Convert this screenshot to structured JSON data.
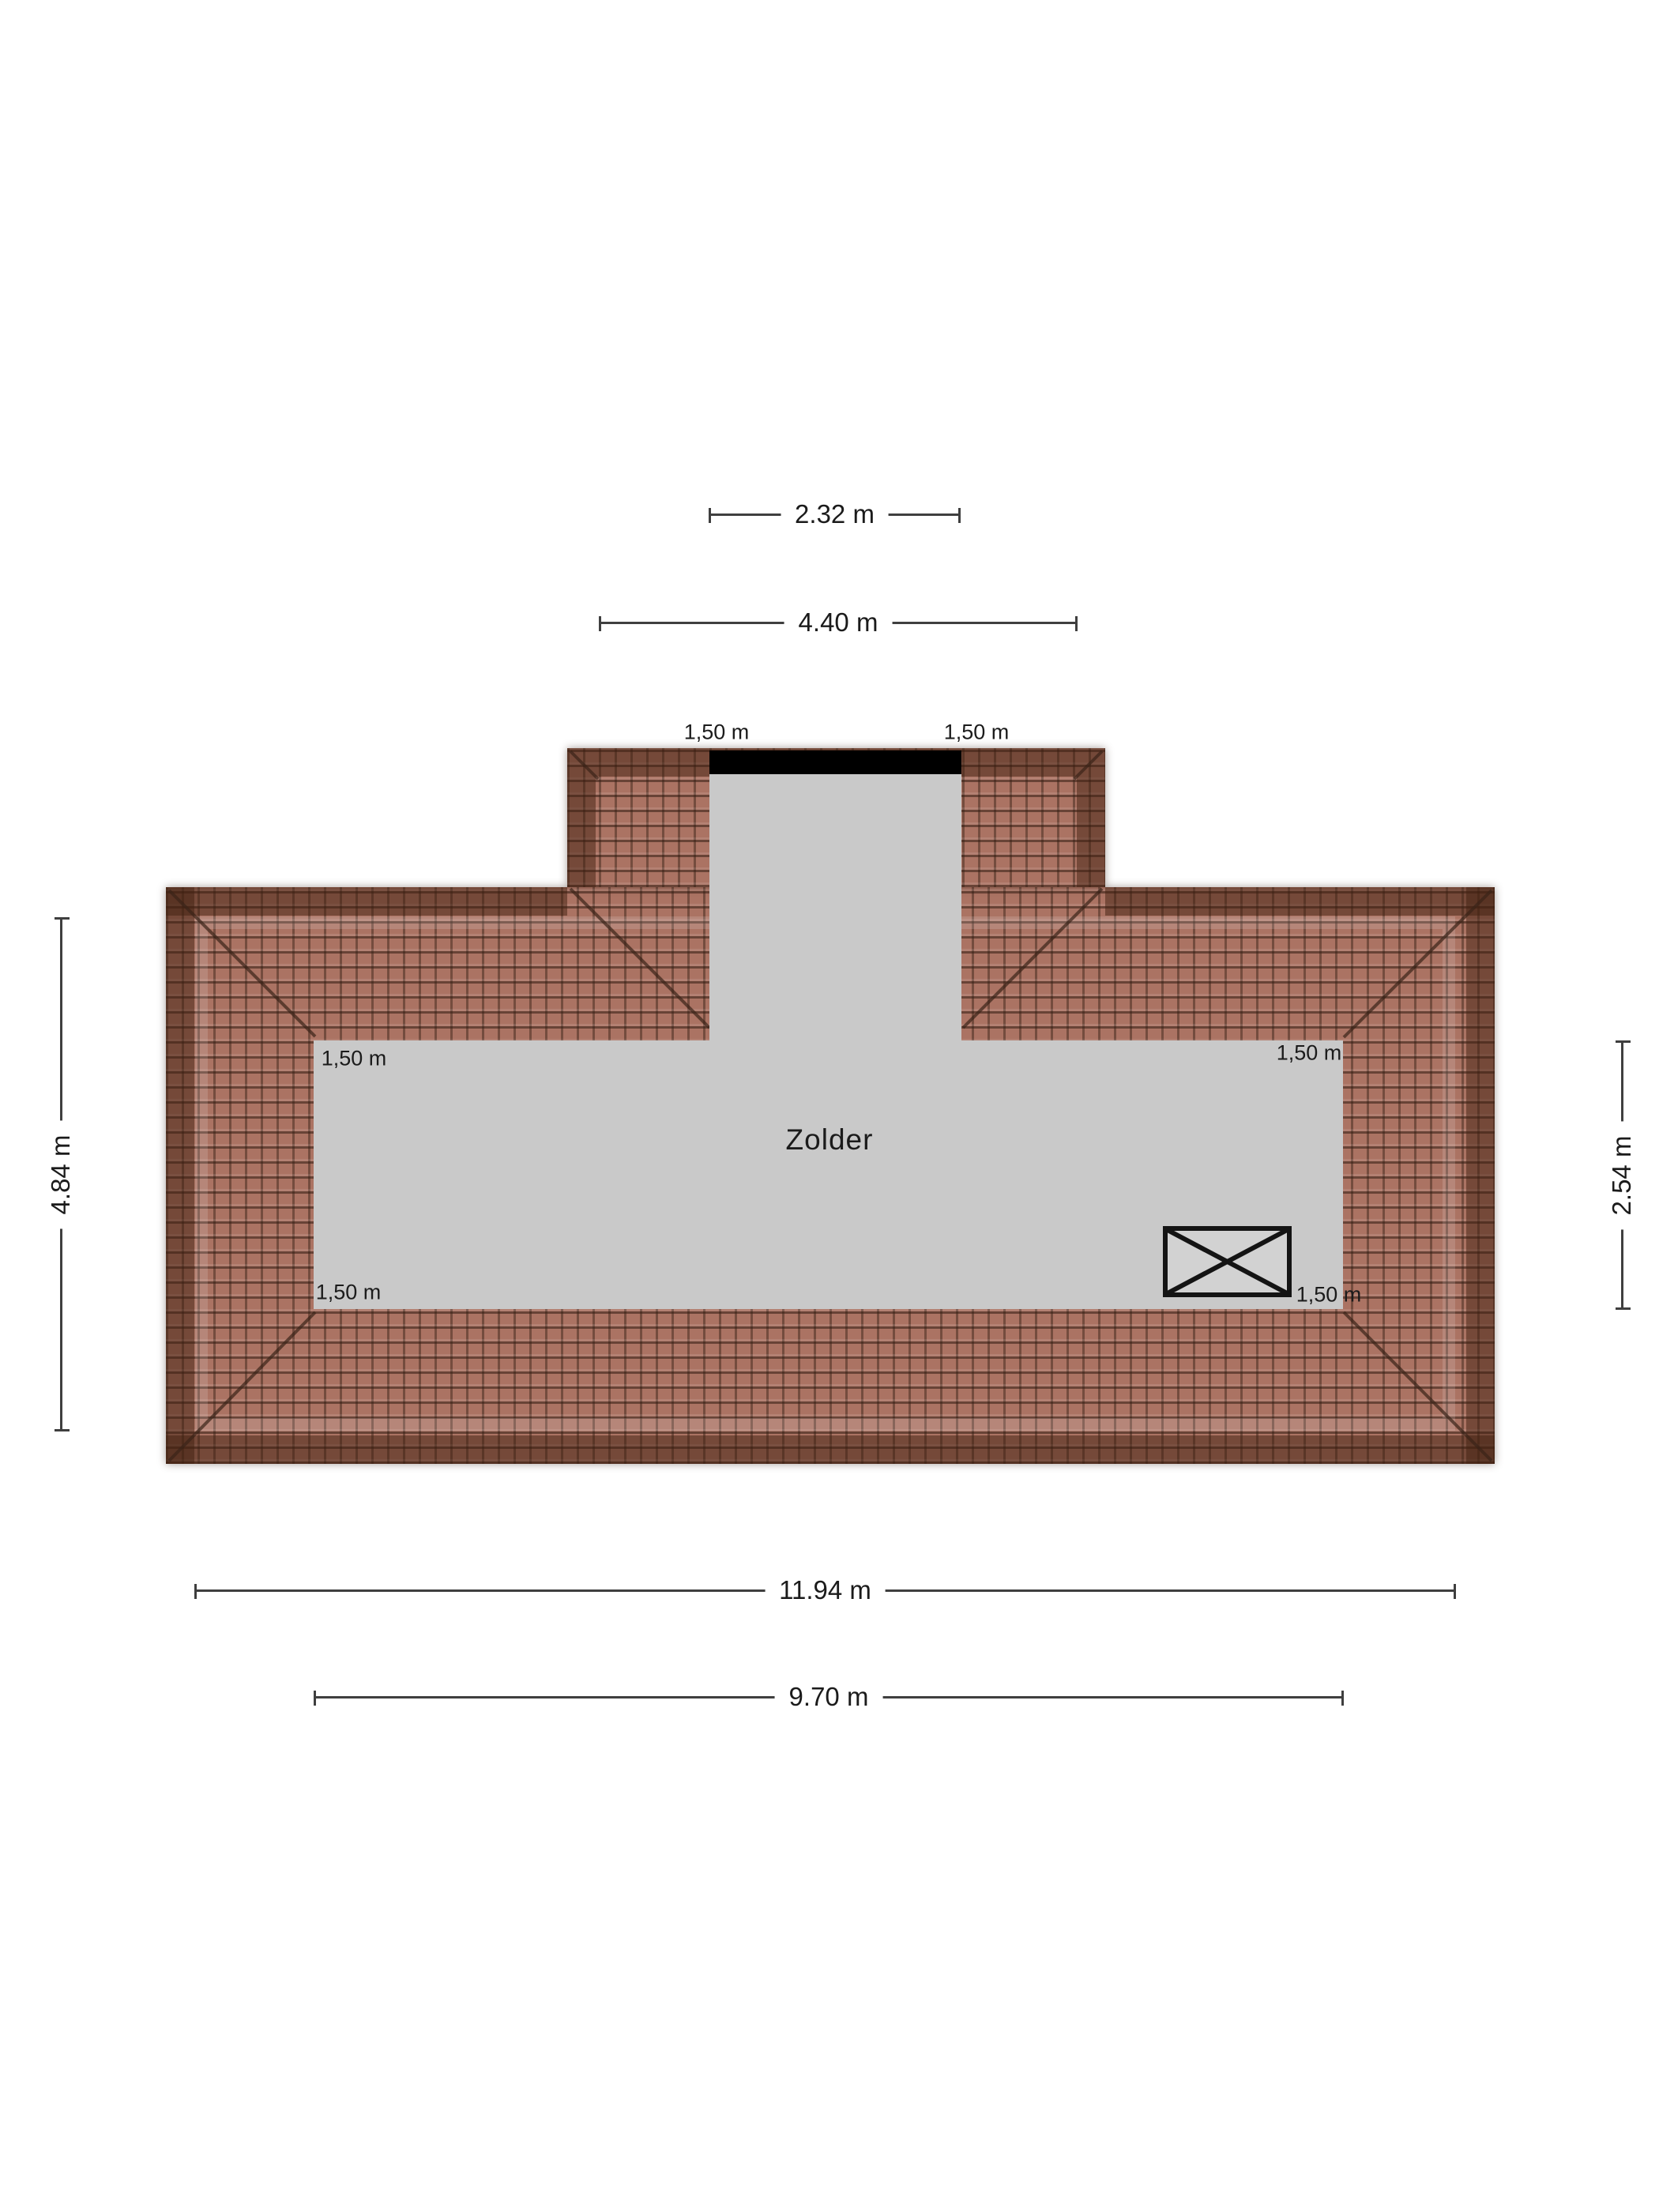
{
  "plan": {
    "room_label": "Zolder",
    "colors": {
      "background": "#ffffff",
      "floor": "#c9c9c9",
      "tile_base": "#ab7363",
      "tile_joint": "#46302a",
      "eave_shade": "#401f10",
      "window_bar": "#000000",
      "dimension_line": "#3f3f3f",
      "text": "#1b1b1b"
    },
    "dimensions": {
      "dormer_inner_width": "2.32 m",
      "dormer_outer_width": "4.40 m",
      "left_wall_height": "4.84 m",
      "floor_height_right": "2.54 m",
      "total_width": "11.94 m",
      "floor_width": "9.70 m"
    },
    "roof_strip_labels": {
      "dormer_left": "1,50 m",
      "dormer_right": "1,50 m",
      "top_left": "1,50 m",
      "top_right": "1,50 m",
      "bottom_left": "1,50 m",
      "bottom_right": "1,50 m"
    },
    "symbols": {
      "stair_opening": "crossed-rectangle",
      "dormer_window": "black-bar"
    }
  }
}
